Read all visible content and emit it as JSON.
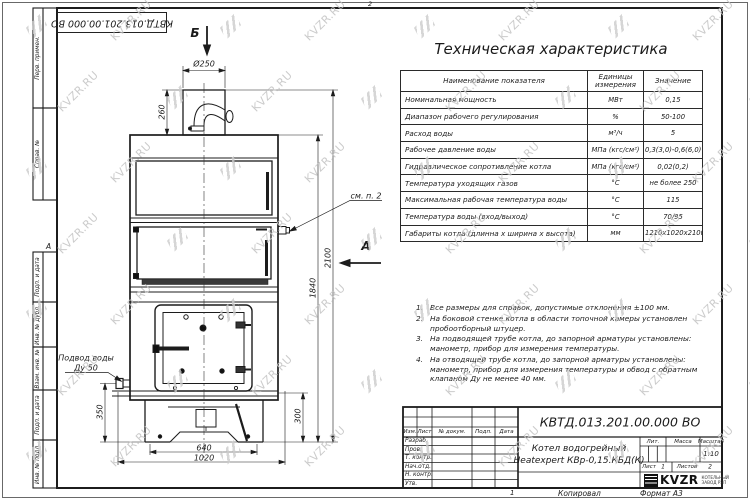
{
  "doc_code": "КВТД.013.201.00.000 ВО",
  "sheet": {
    "top_marker": "2",
    "bottom_marker": "1",
    "copied_label": "Копировал",
    "format_label": "Формат А3",
    "zone_marker": "А"
  },
  "frame_columns": [
    "Перв. примен.",
    "Справ. №",
    "Подп. и дата",
    "Инв. № дубл.",
    "Взам. инв. №",
    "Подп. и дата",
    "Инв. № подл."
  ],
  "tech_table": {
    "title": "Техническая характеристика",
    "headers": [
      "Наименование показателя",
      "Единицы измерения",
      "Значение"
    ],
    "rows": [
      [
        "Номинальная мощность",
        "МВт",
        "0,15"
      ],
      [
        "Диапазон рабочего регулирования",
        "%",
        "50-100"
      ],
      [
        "Расход воды",
        "м³/ч",
        "5"
      ],
      [
        "Рабочее давление воды",
        "МПа (кгс/см²)",
        "0,3(3,0)-0,6(6,0)"
      ],
      [
        "Гидравлическое сопротивление котла",
        "МПа (кгс/см²)",
        "0,02(0,2)"
      ],
      [
        "Температура уходящих газов",
        "°С",
        "не более 250"
      ],
      [
        "Максимальная рабочая температура воды",
        "°С",
        "115"
      ],
      [
        "Температура воды (вход/выход)",
        "°С",
        "70/95"
      ],
      [
        "Габариты котла (длинна х ширина х высота)",
        "мм",
        "1210х1020х2100"
      ]
    ]
  },
  "notes": [
    "Все размеры для справок, допустимые отклонения ±100 мм.",
    "На боковой стенке котла в области топочной камеры установлен пробоотборный штуцер.",
    "На подводящей трубе котла, до запорной арматуры установлены: манометр, прибор для измерения температуры.",
    "На отводящей трубе котла, до запорной арматуры установлены: манометр, прибор для измерения температуры и обвод с обратным клапаном Ду не менее 40 мм."
  ],
  "dimensions": {
    "diameter": "Ø250",
    "chimney_height": "260",
    "body_height": "1840",
    "total_height": "2100",
    "inlet_height": "350",
    "base_height": "300",
    "feet_span": "640",
    "base_width": "1020"
  },
  "labels": {
    "water_inlet_line1": "Подвод воды",
    "water_inlet_line2": "Ду 50",
    "see_note": "см. п. 2",
    "view_b": "Б",
    "view_a": "А"
  },
  "title_block": {
    "designation": "КВТД.013.201.00.000 ВО",
    "header_cols": [
      "Изм.",
      "Лист",
      "№ докум.",
      "Подп.",
      "Дата"
    ],
    "row_labels": [
      "Разраб.",
      "Пров.",
      "Т. контр.",
      "Нач.отд.",
      "Н. контр.",
      "Утв."
    ],
    "name_line1": "Котел водогрейный",
    "name_line2": "Heatexpert КВр-0,15.КБД(К)",
    "lit_label": "Лит.",
    "mass_label": "Масса",
    "scale_label": "Масштаб",
    "scale_value": "1:10",
    "sheet_label": "Лист",
    "sheet_value": "1",
    "sheets_label": "Листов",
    "sheets_value": "2",
    "brand": "KVZR",
    "company_line1": "КОТЕЛЬНЫЙ",
    "company_line2": "ЗАВОД РЭП"
  },
  "watermark": {
    "text": "KVZR.RU"
  }
}
